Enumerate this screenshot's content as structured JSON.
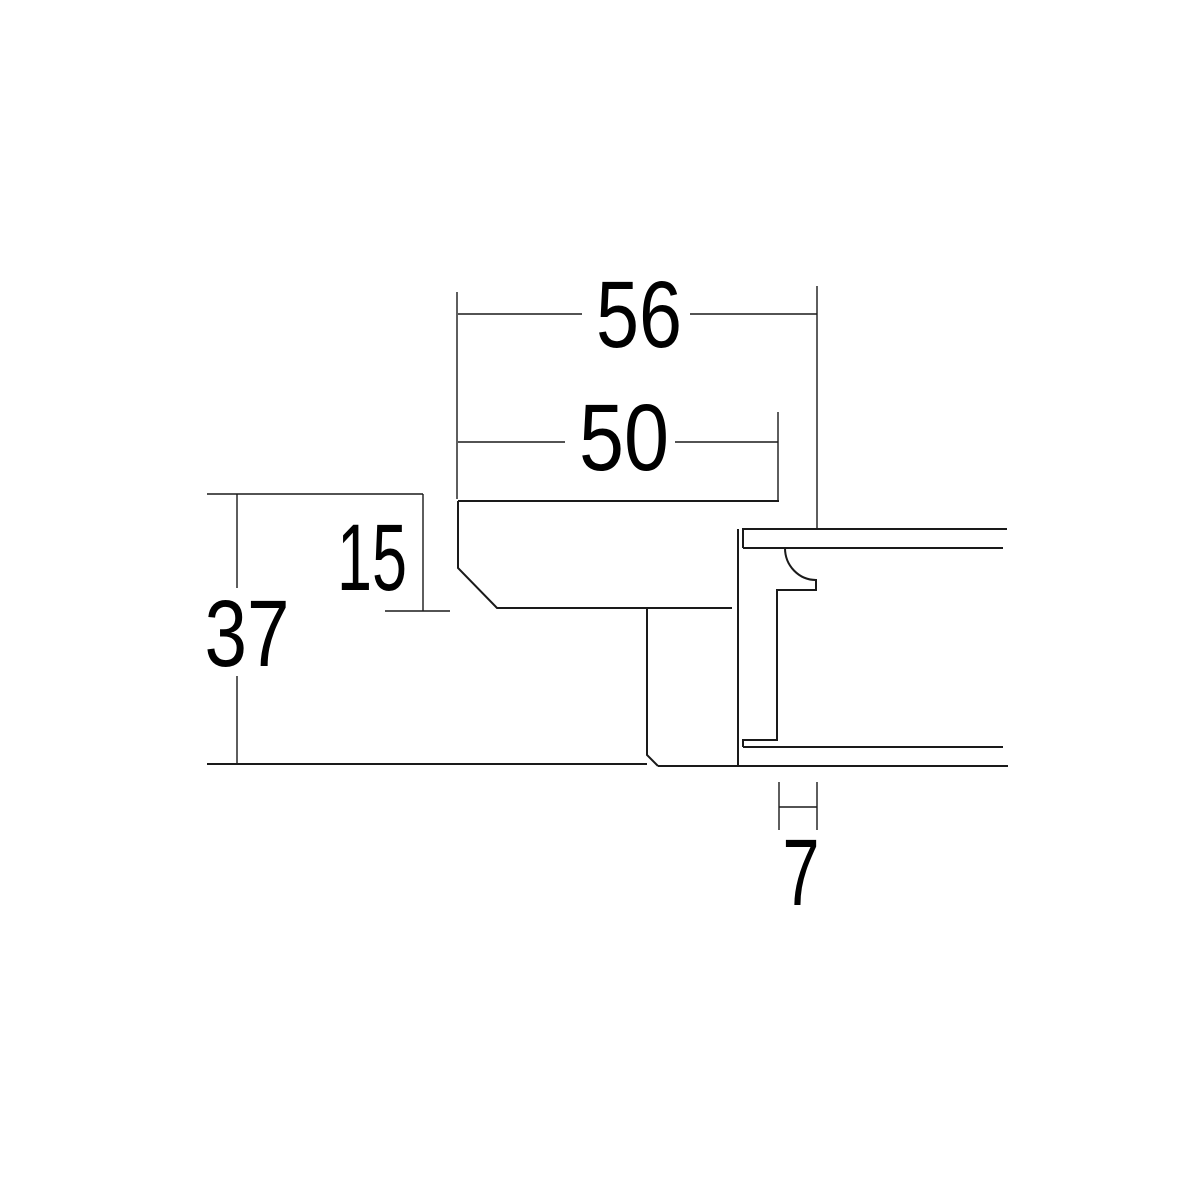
{
  "drawing": {
    "labels": {
      "d56": "56",
      "d50": "50",
      "d15": "15",
      "d37": "37",
      "d7": "7"
    },
    "colors": {
      "background": "#ffffff",
      "line": "#1a1a1a",
      "text": "#000000"
    }
  }
}
